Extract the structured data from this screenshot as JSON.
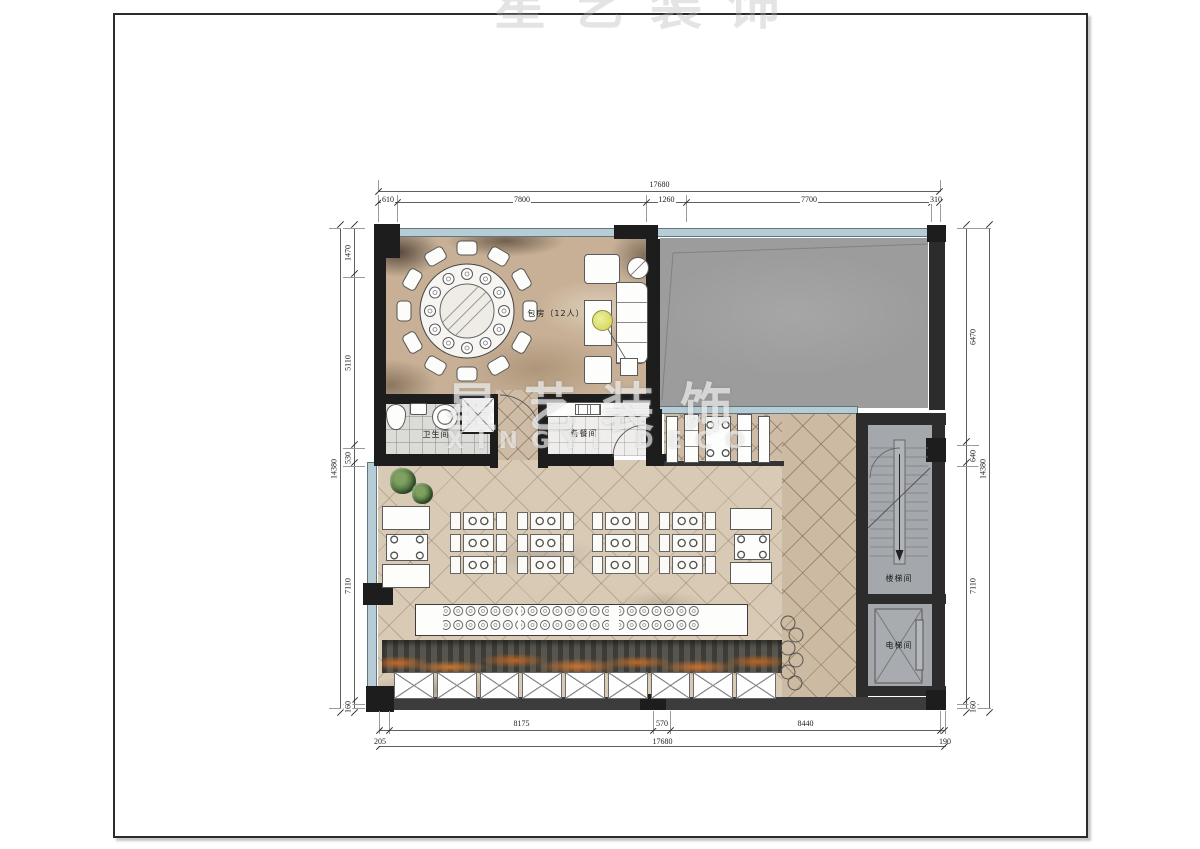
{
  "watermark": {
    "cn": "星艺装饰",
    "en": "XINGYI DECO"
  },
  "rooms": {
    "private_room": "包房（12人）",
    "restroom": "卫生间",
    "pantry": "备餐间",
    "stairwell": "楼梯间",
    "elevator": "电梯间"
  },
  "dims": {
    "top": {
      "overall": "17680",
      "segments": [
        "610",
        "7800",
        "1260",
        "7700",
        "310"
      ]
    },
    "left": {
      "overall": "14380",
      "segments": [
        "1470",
        "5110",
        "530",
        "7110",
        "160"
      ]
    },
    "right": {
      "overall": "14380",
      "segments": [
        "6470",
        "640",
        "7110",
        "160"
      ]
    },
    "bottom": {
      "row1": [
        "8175",
        "570",
        "8440"
      ],
      "row2": [
        "205",
        "17680",
        "190"
      ]
    }
  },
  "palette": {
    "wall": "#1d1d1d",
    "window_glass": "#b7ccd4",
    "gray_room": "#9c9c9c",
    "carpet": "#c7b096",
    "dining_floor": "#d8cab5",
    "corridor_tile": "#cdbaa2",
    "stair_gray": "#a4a8ac",
    "shrub_orange": "#c97232"
  }
}
